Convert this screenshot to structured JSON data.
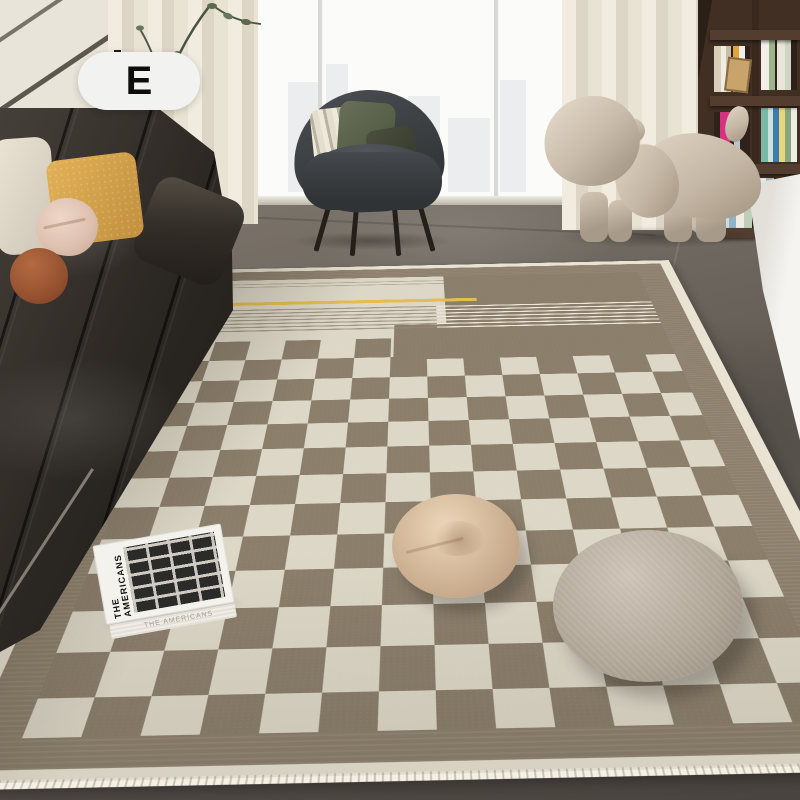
{
  "badge": {
    "label": "E"
  },
  "rug_book": {
    "cover_title": "THE AMERICANS",
    "edge_title": "THE AMERICANS"
  },
  "scene": {
    "objects": [
      "checkerboard-area-rug",
      "leather-sofa",
      "throw-pillows",
      "tiered-side-table",
      "floor-plant-branches",
      "lounge-armchair",
      "puppy-shaped-stool",
      "bookshelf",
      "white-cabinet",
      "floor-window",
      "sheer-curtains",
      "photo-book",
      "round-floor-cushions"
    ]
  },
  "palette": {
    "wall-cream": "#e9e4d9",
    "trim-dark": "#5d584f",
    "curtain-light": "#f1ecdf",
    "curtain-mid": "#ddd6c6",
    "window-white": "#fbfbfa",
    "city-gray": "#dde0e1",
    "shelf-wood": "#412f23",
    "cabinet-white": "#f5f4f1",
    "vase-beige": "#bdb09e",
    "rug-edge": "#e9e3d3",
    "rug-border": "#8d806d",
    "rug-cream": "#ddd7c7",
    "rug-taupe": "#8b7e6b",
    "accent-yellow": "#e5bd4f",
    "serge-white": "#f4f0e5",
    "sofa-dark": "#2b2722",
    "sofa-mid": "#46403a",
    "pillow-cream": "#ece5d6",
    "pillow-yellow": "#e2b258",
    "pillow-blush": "#ddbfae",
    "pillow-rust": "#93502f",
    "chair-shell": "#3a3d40",
    "chair-seat": "#44474b",
    "cushion-stripe-light": "#efe9da",
    "cushion-olive": "#555e47",
    "cushion-darkolive": "#3b4032",
    "dog-light": "#e0d4c5",
    "dog-mid": "#c5b7a5",
    "dog-dark": "#a2937f",
    "cushion-small-a": "#ecd6ba",
    "cushion-small-b": "#cbae90",
    "cushion-large-a": "#cdc4b7",
    "cushion-large-b": "#b0a698",
    "book-white": "#f4f2ec",
    "book-ink": "#15130f",
    "badge-bg": "#f2f2f1"
  }
}
